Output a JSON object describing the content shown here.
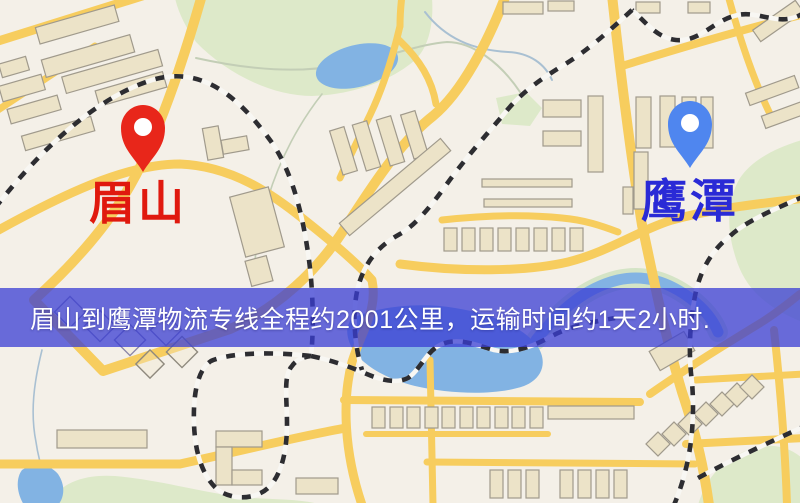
{
  "map": {
    "origin": {
      "name": "眉山",
      "marker_color": "#e8261a",
      "label_color": "#e0190e"
    },
    "destination": {
      "name": "鹰潭",
      "marker_color": "#4f86ef",
      "label_color": "#2a2ad6"
    },
    "banner": {
      "text": "眉山到鹰潭物流专线全程约2001公里，运输时间约1天2小时.",
      "bg_color": "rgba(58,62,212,0.75)",
      "text_color": "#ffffff"
    },
    "route_distance_km": "2001",
    "transit_time": "1天2小时"
  },
  "colors": {
    "background": "#f4f0e8",
    "road": "#f7cd5e",
    "building_fill": "#ece3c8",
    "building_stroke": "#a09a8c",
    "green_area": "#dde9c9",
    "green_margin": "#d4e4c6",
    "water": "#82b3e3",
    "stream_blue": "#a9c0d2",
    "stream_green": "#c3ceb6",
    "railway_dark": "#2d2d31"
  }
}
